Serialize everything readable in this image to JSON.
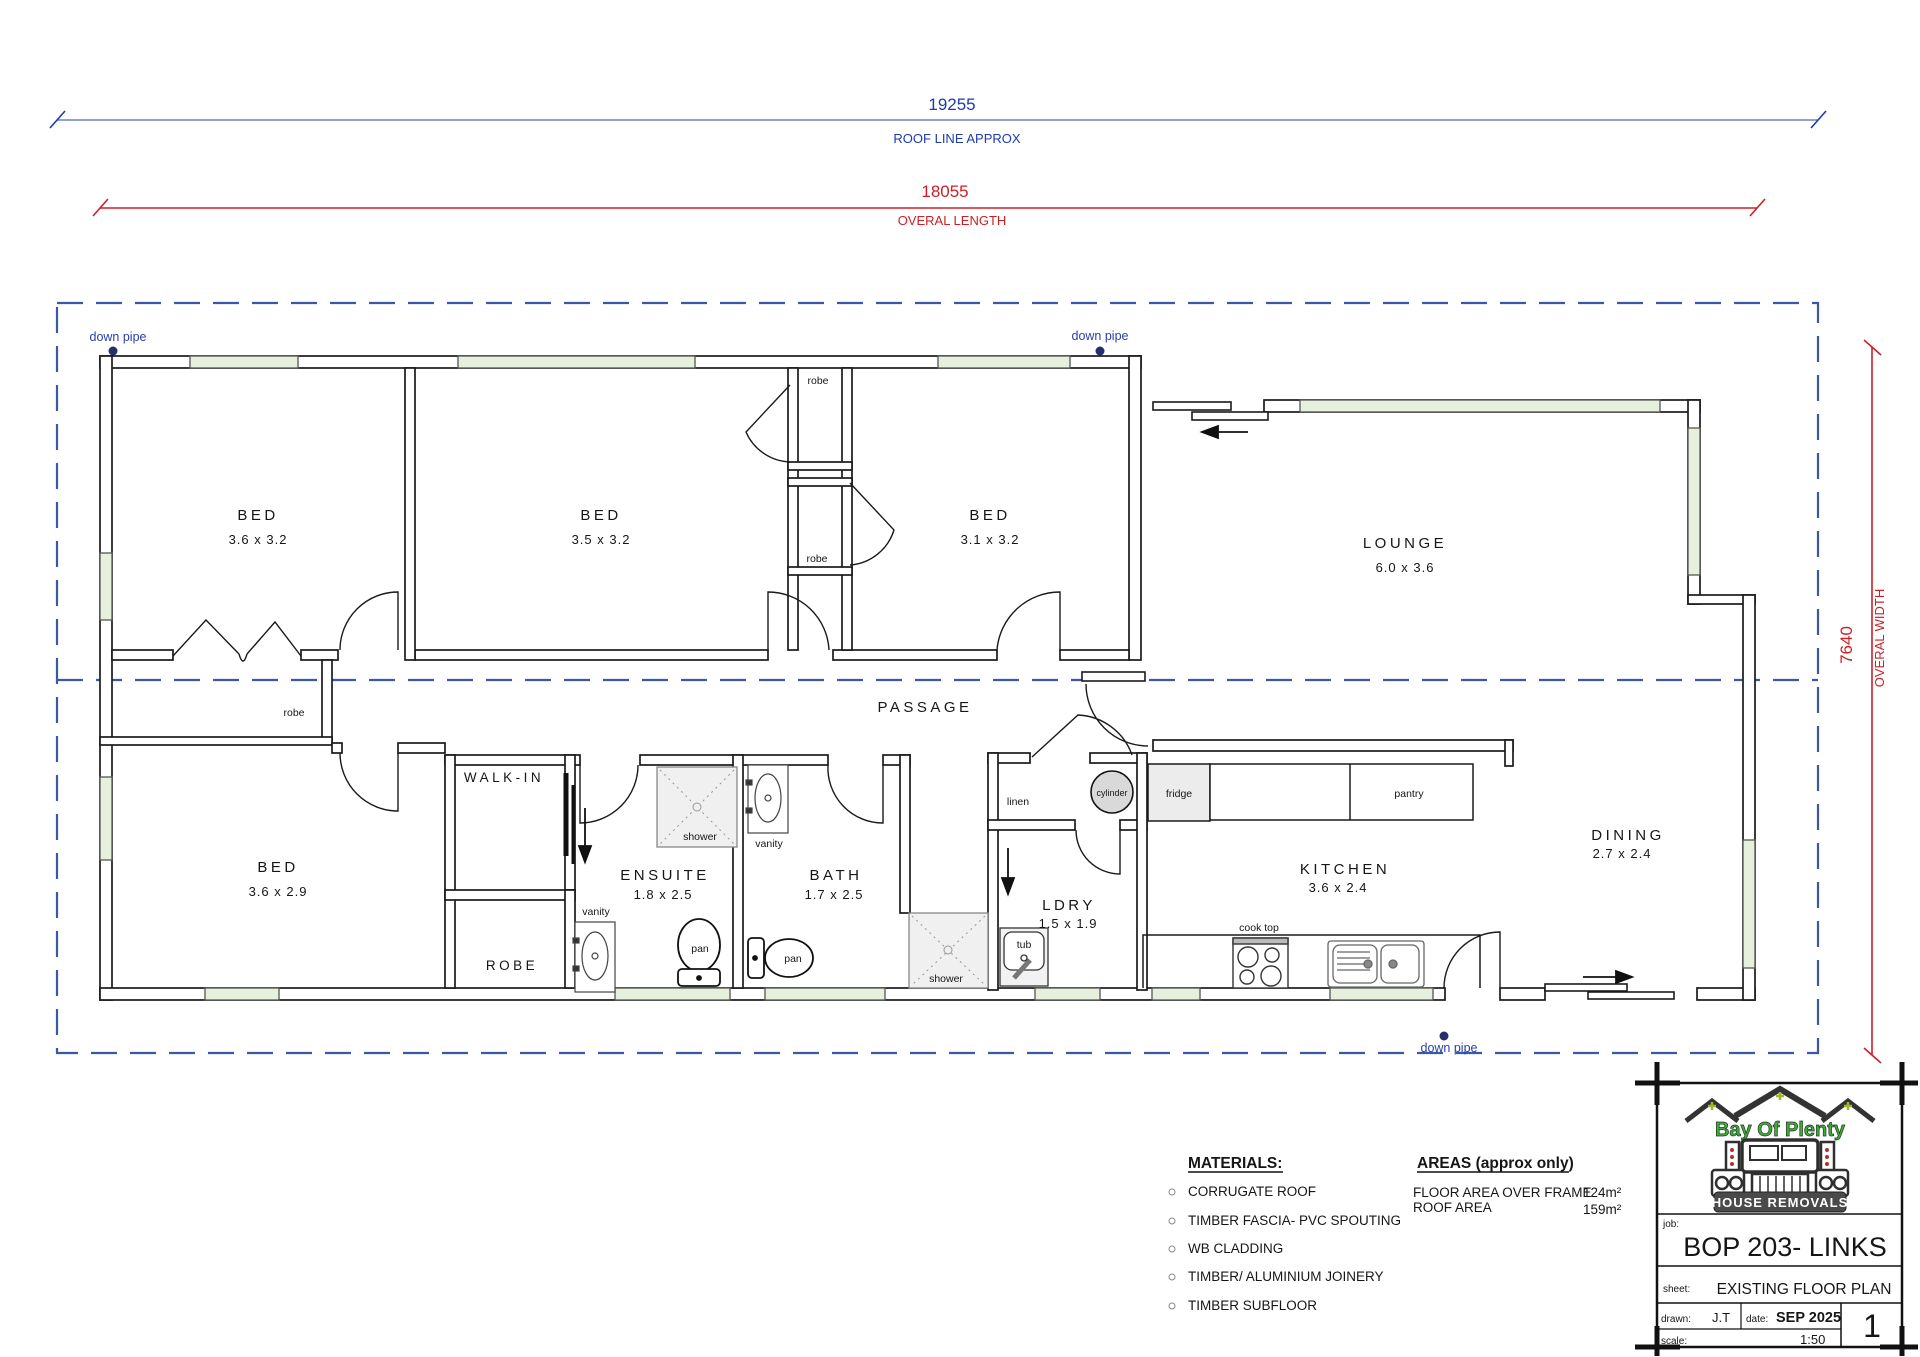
{
  "dimensions": {
    "roof": {
      "value": "19255",
      "label": "ROOF LINE APPROX"
    },
    "length": {
      "value": "18055",
      "label": "OVERAL LENGTH"
    },
    "width": {
      "value": "7640",
      "label": "OVERAL WIDTH"
    }
  },
  "labels": {
    "down_pipe": "down pipe"
  },
  "rooms": {
    "bed1": {
      "name": "BED",
      "dims": "3.6 x 3.2"
    },
    "bed2": {
      "name": "BED",
      "dims": "3.5 x 3.2"
    },
    "bed3": {
      "name": "BED",
      "dims": "3.1 x 3.2"
    },
    "lounge": {
      "name": "LOUNGE",
      "dims": "6.0 x 3.6"
    },
    "bed4": {
      "name": "BED",
      "dims": "3.6 x 2.9"
    },
    "ensuite": {
      "name": "ENSUITE",
      "dims": "1.8 x 2.5"
    },
    "bath": {
      "name": "BATH",
      "dims": "1.7 x 2.5"
    },
    "ldry": {
      "name": "LDRY",
      "dims": "1.5 x 1.9"
    },
    "kitchen": {
      "name": "KITCHEN",
      "dims": "3.6 x 2.4"
    },
    "dining": {
      "name": "DINING",
      "dims": "2.7 x 2.4"
    },
    "passage": {
      "name": "PASSAGE"
    },
    "walk_in": {
      "name": "WALK-IN"
    },
    "robe_room": {
      "name": "ROBE"
    }
  },
  "fixtures": {
    "robe": "robe",
    "linen": "linen",
    "cylinder": "cylinder",
    "fridge": "fridge",
    "pantry": "pantry",
    "cook_top": "cook top",
    "shower": "shower",
    "vanity": "vanity",
    "pan": "pan",
    "tub": "tub"
  },
  "materials": {
    "title": "MATERIALS:",
    "items": [
      "CORRUGATE ROOF",
      "TIMBER FASCIA- PVC SPOUTING",
      "WB CLADDING",
      "TIMBER/ ALUMINIUM JOINERY",
      "TIMBER SUBFLOOR"
    ]
  },
  "areas": {
    "title": "AREAS (approx only)",
    "rows": [
      {
        "label": "FLOOR AREA OVER FRAME",
        "value": "124m²"
      },
      {
        "label": "ROOF AREA",
        "value": "159m²"
      }
    ]
  },
  "title_block": {
    "logo_line1": "Bay Of Plenty",
    "logo_line2": "HOUSE REMOVALS",
    "job_label": "job:",
    "job": "BOP 203- LINKS",
    "sheet_label": "sheet:",
    "sheet": "EXISTING  FLOOR PLAN",
    "drawn_label": "drawn:",
    "drawn": "J.T",
    "date_label": "date:",
    "date": "SEP 2025",
    "scale_label": "scale:",
    "scale": "1:50",
    "page": "1"
  },
  "colors": {
    "dim_blue": "#1e3ab2",
    "dim_red": "#cc2027",
    "roofline_dash": "#3a57a8",
    "wall": "#1a1a1a",
    "window_fill": "#e7efdd",
    "shower_fill": "#f0f0f0",
    "appliance_fill": "#ececec",
    "cylinder_fill": "#d9d9d9",
    "logo_green": "#44a83e"
  }
}
